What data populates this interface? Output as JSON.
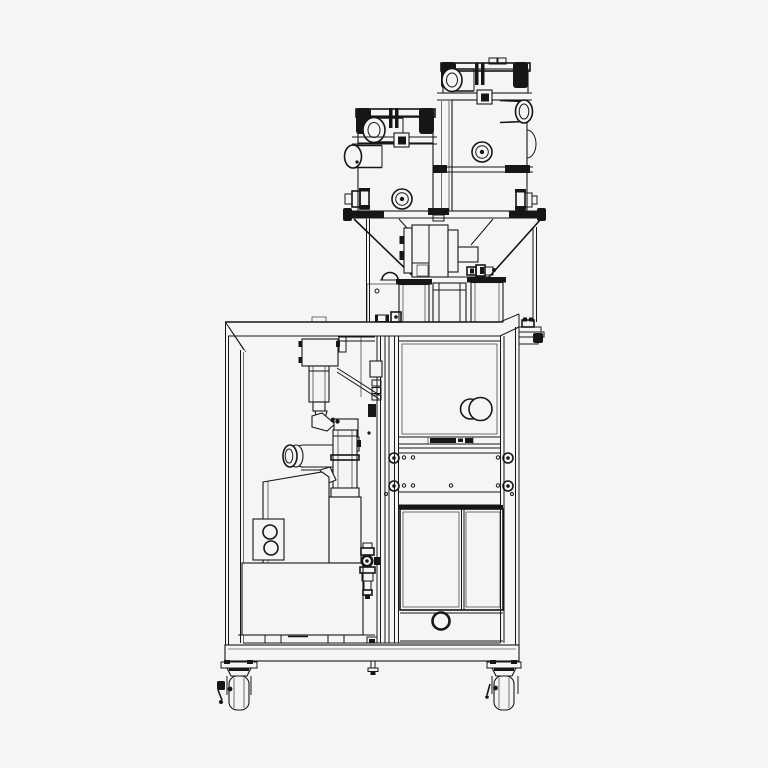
{
  "title": "Dosing and packaging machine – side elevation line drawing",
  "drawing": {
    "background_color": "#f5f5f5",
    "line_color": "#161616",
    "canvas": {
      "width": 768,
      "height": 768
    },
    "style": "monochrome technical CAD outline, no text labels"
  },
  "parts": {
    "feeder_left": {
      "label": "Front vacuum feeder unit",
      "features": [
        "hinged lid with toggle clamps",
        "air inlet cylinder",
        "side suction port",
        "sight knob",
        "hose fitting"
      ]
    },
    "feeder_right": {
      "label": "Rear vacuum feeder unit",
      "features": [
        "hinged lid with toggle clamps",
        "air inlet cylinder",
        "side suction port",
        "sight knob",
        "hose fitting",
        "mid mounting rail"
      ]
    },
    "hopper_funnel": {
      "label": "Twin discharge funnel with clamped flange ring"
    },
    "dosing_gearbox": {
      "label": "Auger dosing drive block with valve fittings"
    },
    "pedestals": {
      "label": "Mounting pedestals and center drop tube on cabinet top"
    },
    "cabinet": {
      "label": "Machine cabinet frame",
      "features": [
        "top beam",
        "left post",
        "right post",
        "base skirt"
      ]
    },
    "filling_mechanism": {
      "label": "Left bay: filler head, nozzle, pump motor, product pump housing, control panel plate"
    },
    "right_compartment": {
      "label": "Right bay: access panel with round latch knob, bolt rows, double doors, vent hole"
    },
    "side_bracket": {
      "label": "Right-hand accessory mounting bracket"
    },
    "casters": {
      "label": "Swivel casters with brake levers"
    }
  }
}
